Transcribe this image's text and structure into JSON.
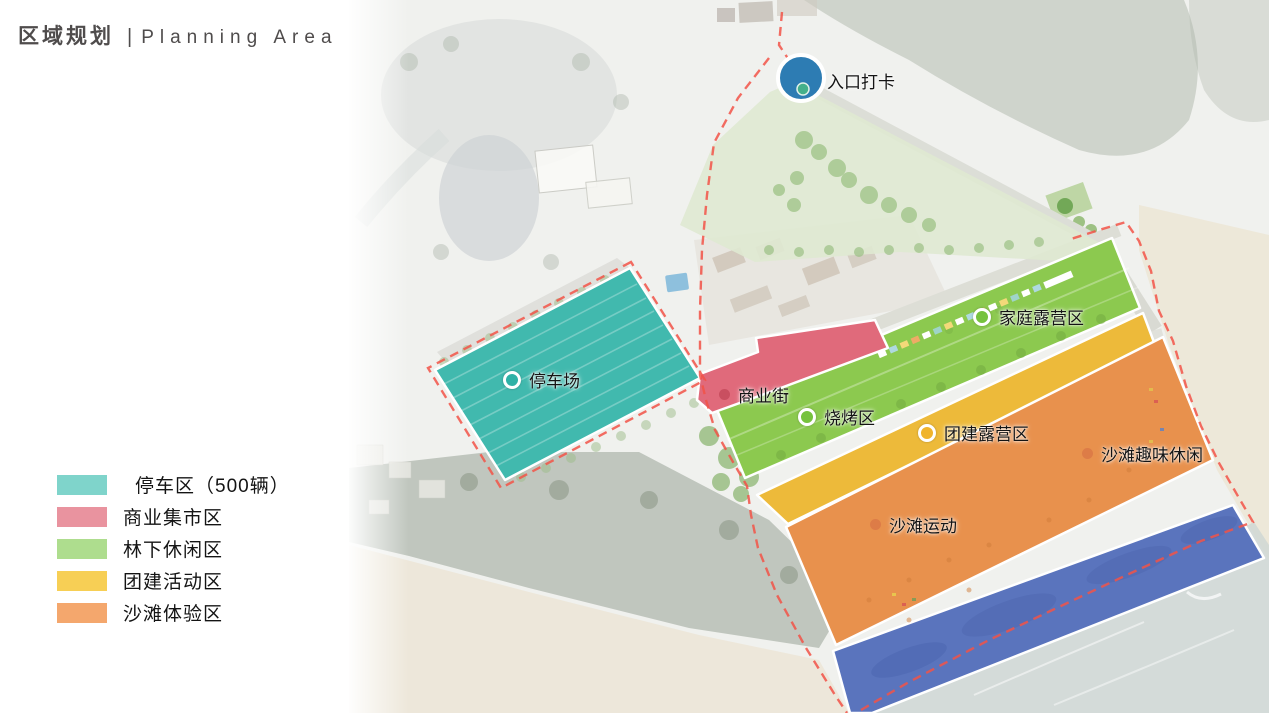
{
  "header": {
    "title_zh": "区域规划",
    "divider": "|",
    "title_en": "Planning Area"
  },
  "legend": {
    "items": [
      {
        "label": "停车区（500辆）",
        "color": "#7fd4cb"
      },
      {
        "label": "商业集市区",
        "color": "#e9939f"
      },
      {
        "label": "林下休闲区",
        "color": "#aedd8e"
      },
      {
        "label": "团建活动区",
        "color": "#f7cf55"
      },
      {
        "label": "沙滩体验区",
        "color": "#f4a76d"
      }
    ]
  },
  "map": {
    "zone_colors": {
      "parking": "#41b9ae",
      "commercial": "#e06a7b",
      "forest_leisure": "#8cc94f",
      "team_building": "#edba3a",
      "beach_experience": "#e8914d",
      "water_zone": "#5a74bd",
      "entrance_lawn": "#dfe9d2"
    },
    "boundary_color": "#f25348",
    "entrance": {
      "circle_color": "#2d7cb3",
      "dot_color": "#44b08b"
    },
    "labels": [
      {
        "id": "entrance-checkin",
        "text": "入口打卡"
      },
      {
        "id": "family-camping",
        "text": "家庭露营区",
        "marker_color": "#76c23d"
      },
      {
        "id": "parking-lot",
        "text": "停车场",
        "marker_color": "#2fb1a6"
      },
      {
        "id": "commercial-street",
        "text": "商业街",
        "marker_color": "#c94f60"
      },
      {
        "id": "bbq-area",
        "text": "烧烤区",
        "marker_color": "#76c23d"
      },
      {
        "id": "team-camping",
        "text": "团建露营区",
        "marker_color": "#f0b42c"
      },
      {
        "id": "beach-fun",
        "text": "沙滩趣味休闲",
        "marker_color": "#dd7c47"
      },
      {
        "id": "beach-sports",
        "text": "沙滩运动",
        "marker_color": "#dd7c47"
      }
    ]
  }
}
